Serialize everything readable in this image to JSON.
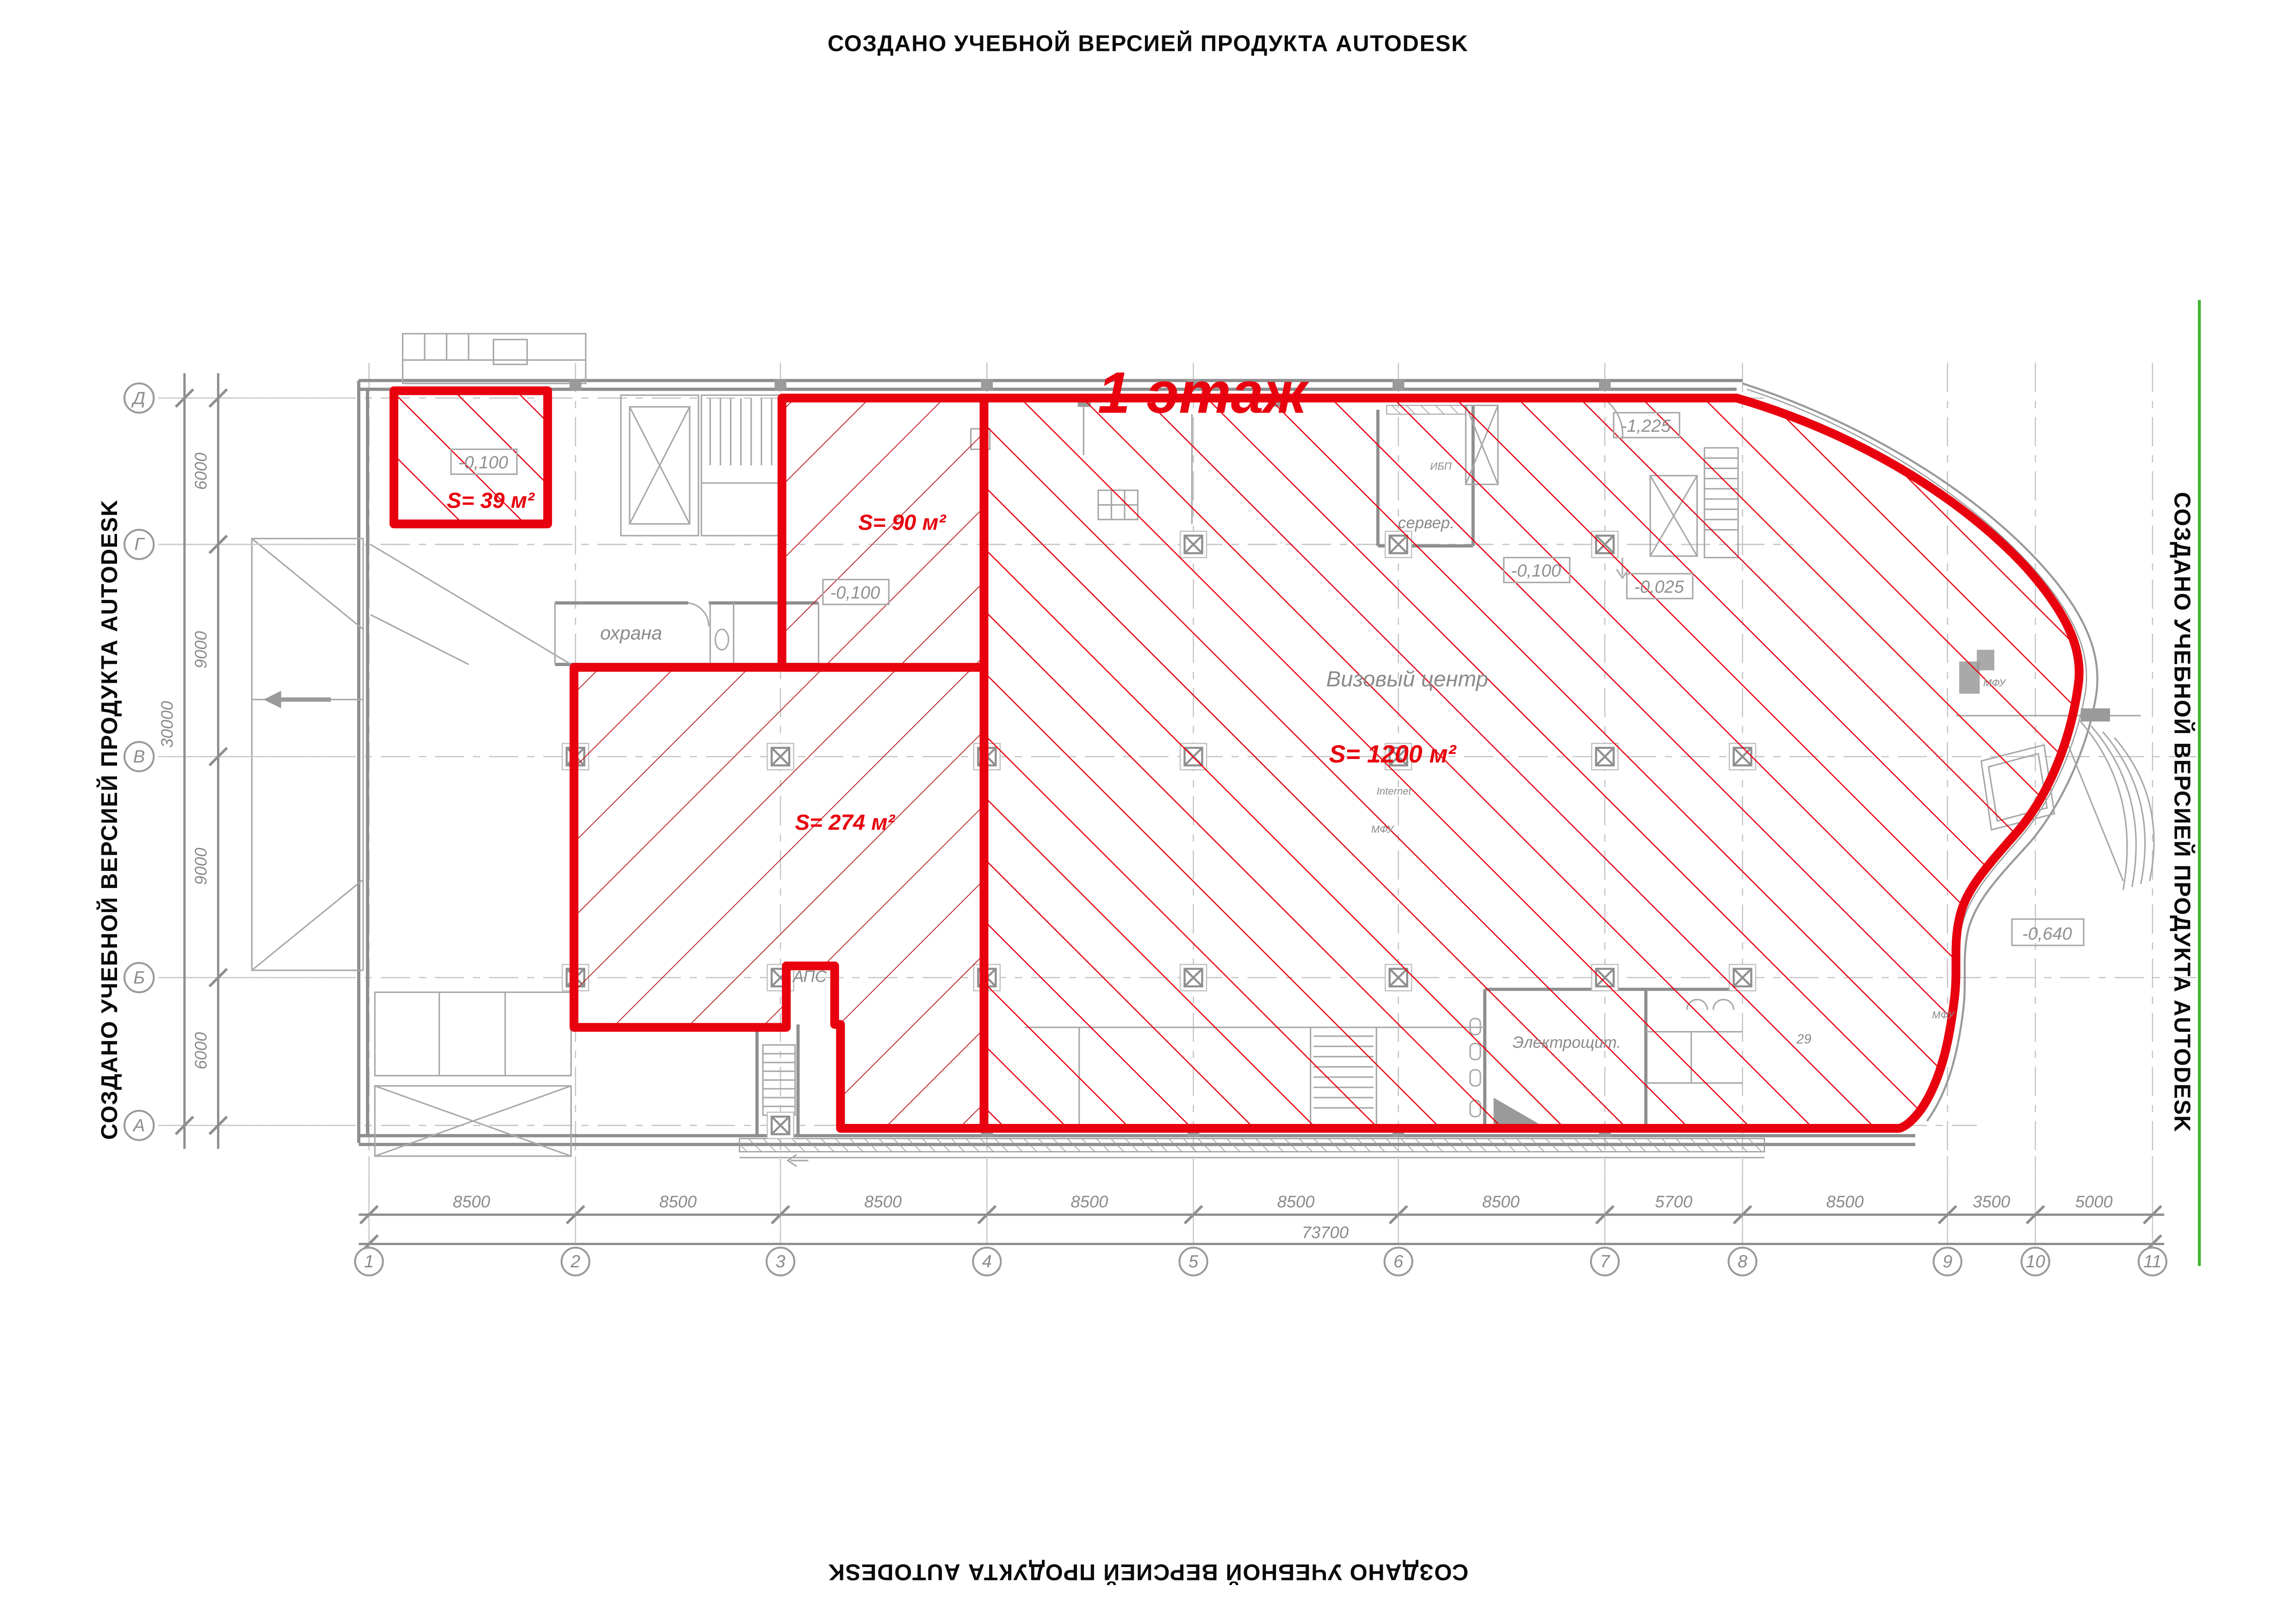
{
  "watermark": {
    "text": "СОЗДАНО УЧЕБНОЙ ВЕРСИЕЙ ПРОДУКТА AUTODESK"
  },
  "title": {
    "text": "1 этаж"
  },
  "colors": {
    "red": "#e8000e",
    "hatch_dark_red": "#b5121b",
    "gray": "#9a9a9a",
    "text_gray": "#8a8a8a",
    "green": "#3cb72e",
    "black": "#0a0a0a"
  },
  "areas": {
    "a39": {
      "label": "S= 39 м²"
    },
    "a90": {
      "label": "S= 90 м²"
    },
    "a274": {
      "label": "S= 274 м²"
    },
    "a1200": {
      "label": "S= 1200 м²"
    }
  },
  "rooms": {
    "okhrana": "охрана",
    "server": "сервер.",
    "visa_center": "Визовый центр",
    "aps": "АПС",
    "electro": "Электрощит.",
    "ibp": "ИБП",
    "internet": "Internet",
    "mfu": "МФУ",
    "room29": "29"
  },
  "elevations": {
    "e1": "-0,100",
    "e2": "-0,100",
    "e3": "-0,100",
    "e4": "-0,025",
    "e5": "-1,225",
    "e6": "-0,640"
  },
  "dimensions": {
    "bottom": {
      "segments": [
        "8500",
        "8500",
        "8500",
        "8500",
        "8500",
        "8500",
        "5700",
        "8500",
        "3500",
        "5000"
      ],
      "total": "73700"
    },
    "left": {
      "segments": [
        "6000",
        "9000",
        "9000",
        "6000"
      ],
      "total": "30000"
    }
  },
  "axes": {
    "columns": [
      "1",
      "2",
      "3",
      "4",
      "5",
      "6",
      "7",
      "8",
      "9",
      "10",
      "11"
    ],
    "rows": [
      "Д",
      "Г",
      "В",
      "Б",
      "А"
    ]
  }
}
